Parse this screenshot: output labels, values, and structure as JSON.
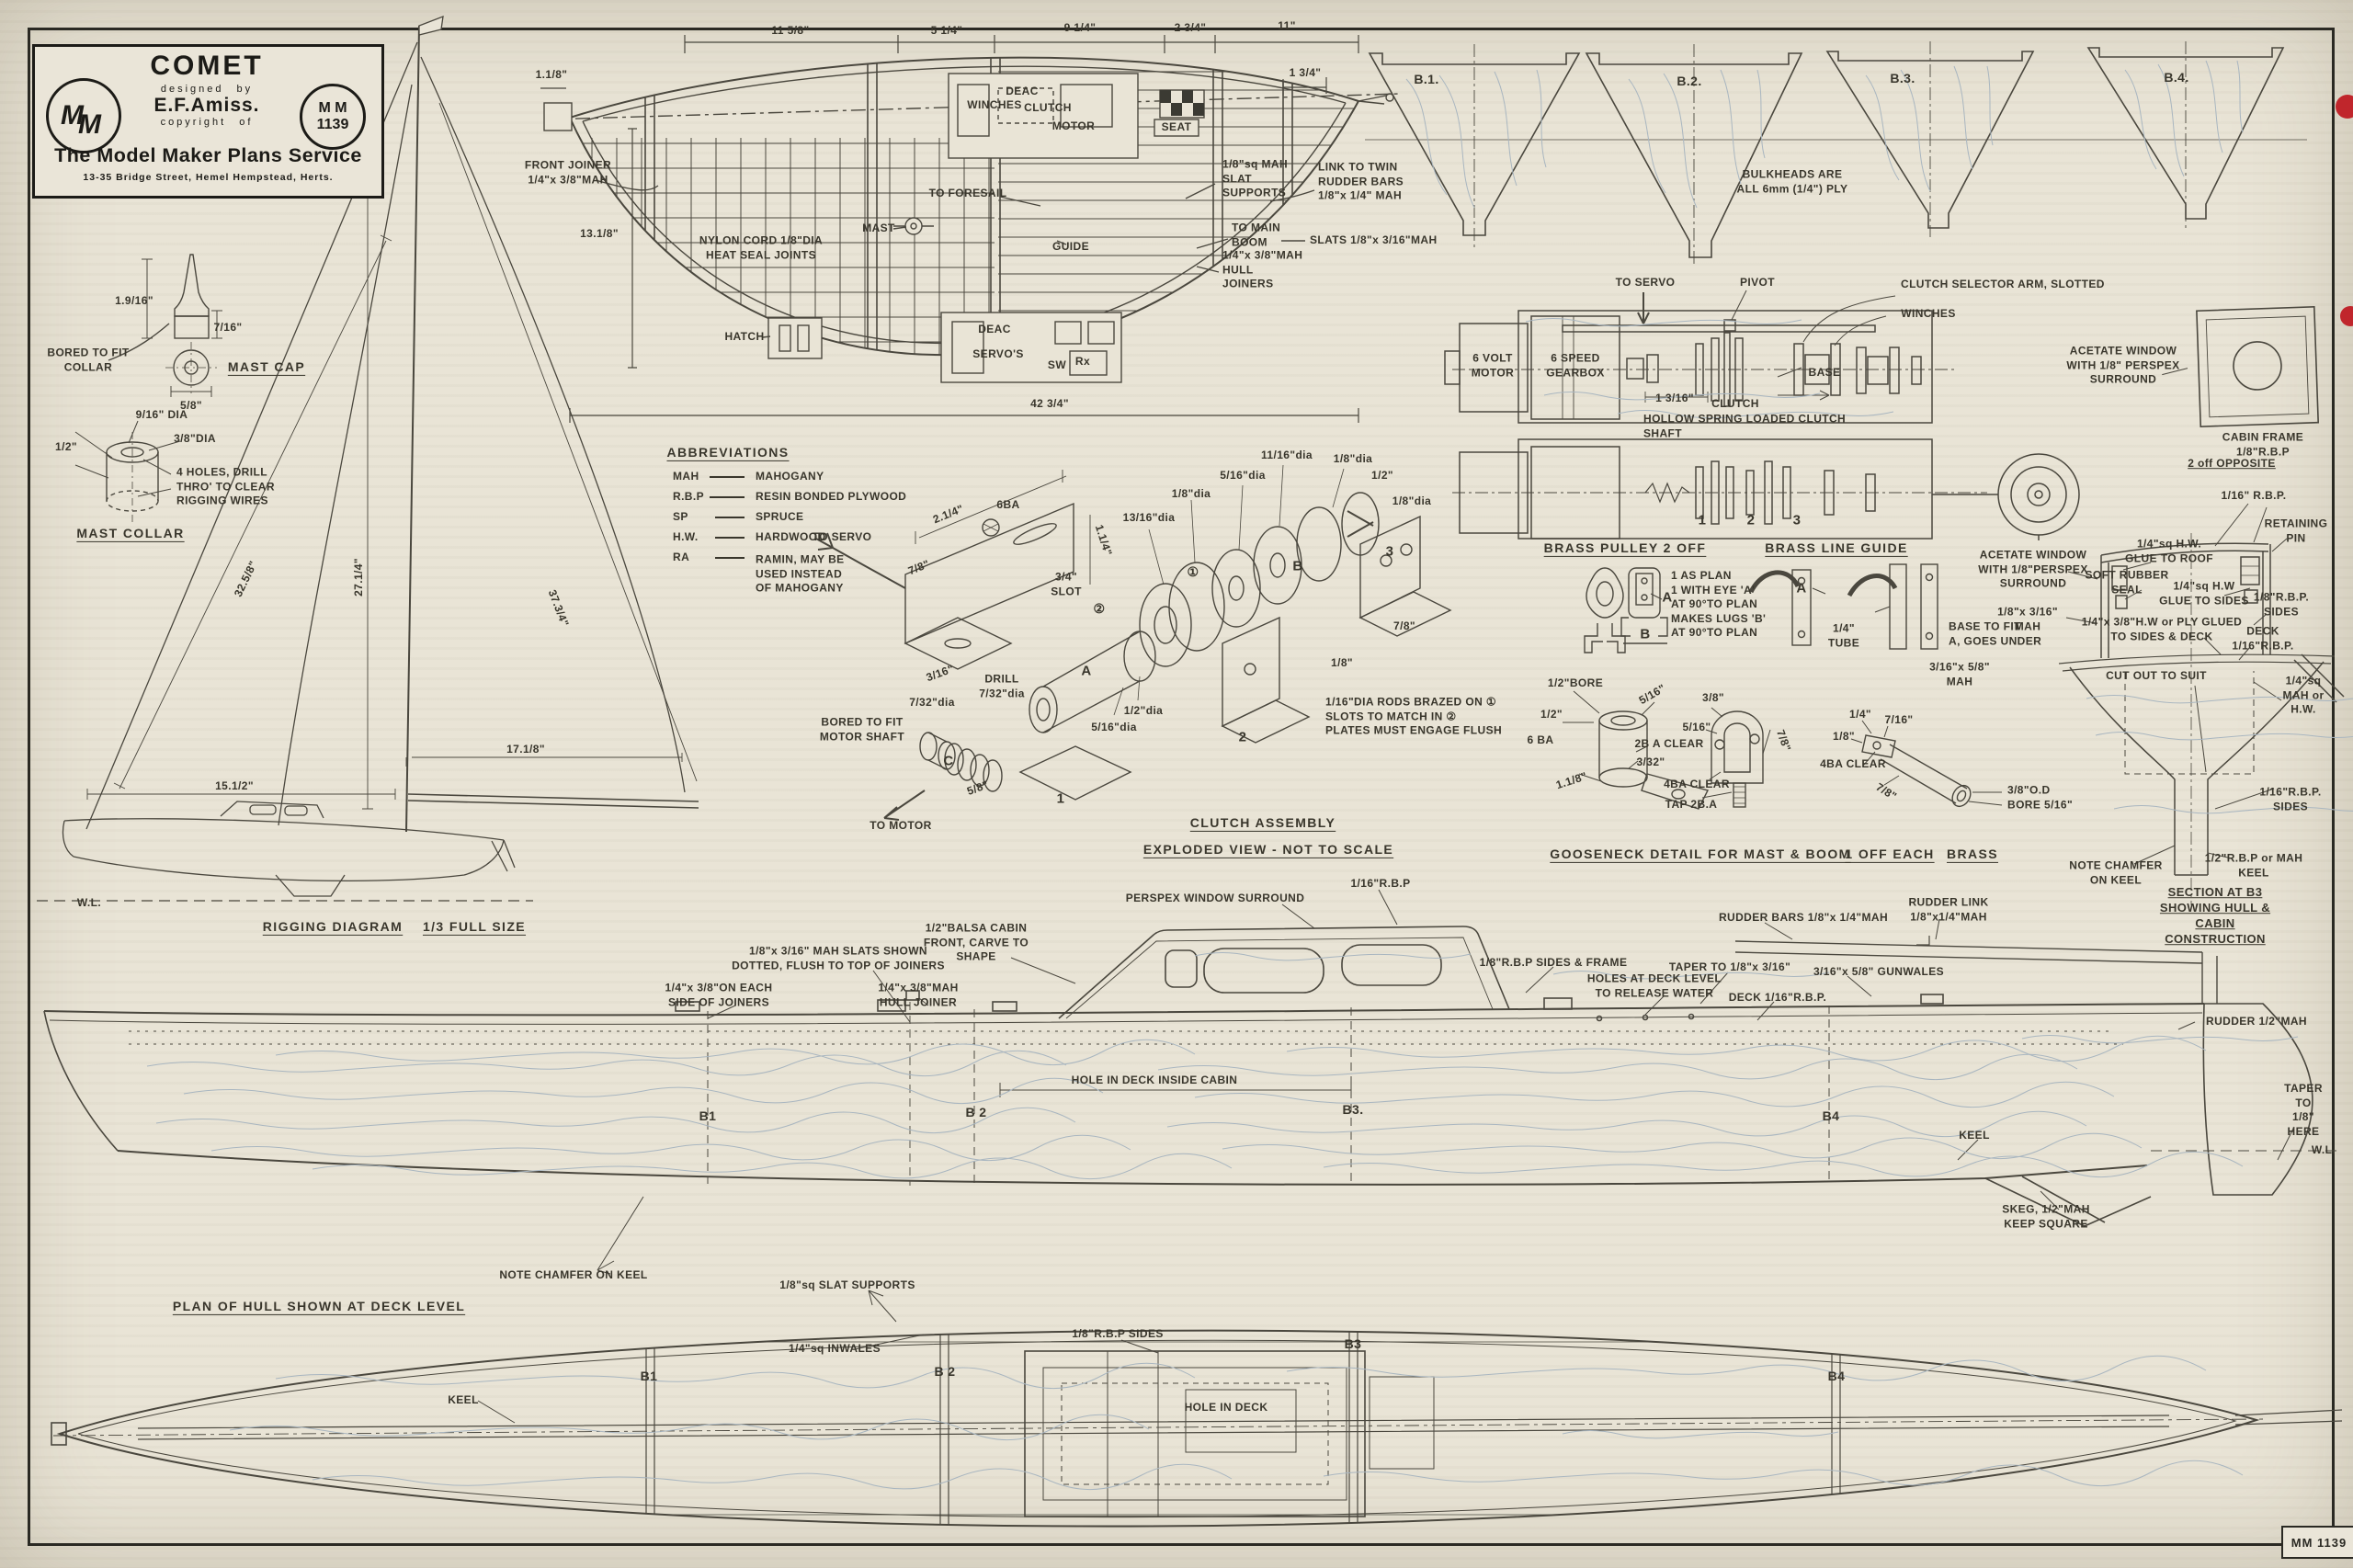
{
  "title": {
    "name": "COMET",
    "designed_by": "designed by",
    "designer": "E.F.Amiss.",
    "copyright_of": "copyright of",
    "logo_m1": "M",
    "logo_m2": "M",
    "plan_no_line1": "M M",
    "plan_no_line2": "1139",
    "service": "The Model Maker Plans Service",
    "address": "13-35 Bridge Street, Hemel Hempstead, Herts."
  },
  "deck": {
    "dim_11_58": "11 5/8\"",
    "dim_5_14": "5 1/4\"",
    "dim_9_14": "9 1/4\"",
    "dim_2_34": "2 3/4\"",
    "dim_11": "11\"",
    "dim_1_34": "1 3/4\"",
    "dim_1_18": "1.1/8\"",
    "dim_13_18": "13.1/8\"",
    "dim_overall": "42 3/4\"",
    "front_joiner": "FRONT JOINER\n1/4\"x 3/8\"MAH",
    "nylon": "NYLON CORD 1/8\"DIA\nHEAT SEAL JOINTS",
    "hatch": "HATCH",
    "mast": "MAST",
    "to_foresail": "TO FORESAIL",
    "guide": "GUIDE",
    "deac": "DEAC",
    "winches": "WINCHES",
    "clutch": "CLUTCH",
    "motor": "MOTOR",
    "seat": "SEAT",
    "deac2": "DEAC",
    "servos": "SERVO'S",
    "sw": "SW",
    "rx": "Rx",
    "slat_supports": "1/8\"sq MAH\nSLAT\nSUPPORTS",
    "link_rudder": "LINK TO TWIN\nRUDDER BARS\n1/8\"x 1/4\" MAH",
    "to_main_boom": "TO MAIN\nBOOM",
    "slats": "SLATS 1/8\"x 3/16\"MAH",
    "hull_joiners": "1/4\"x 3/8\"MAH\nHULL\nJOINERS"
  },
  "bulk": {
    "b1": "B.1.",
    "b2": "B.2.",
    "b3": "B.3.",
    "b4": "B.4.",
    "note": "BULKHEADS ARE\nALL 6mm (1/4\") PLY"
  },
  "mastcap": {
    "h": "1.9/16\"",
    "w": "7/16\"",
    "bored": "BORED TO FIT\nCOLLAR",
    "dia": "5/8\"",
    "title": "MAST CAP"
  },
  "collar": {
    "dia1": "9/16\" DIA",
    "dia2": "3/8\"DIA",
    "h": "1/2\"",
    "holes": "4 HOLES, DRILL\nTHRO' TO CLEAR\nRIGGING WIRES",
    "title": "MAST COLLAR"
  },
  "rig": {
    "forestay": "32.5/8\"",
    "luff": "27.1/4\"",
    "leech": "37.3/4\"",
    "boom": "17.1/8\"",
    "foot": "15.1/2\"",
    "wl": "W.L.",
    "title": "RIGGING DIAGRAM",
    "scale": "1/3 FULL SIZE"
  },
  "abbr": {
    "title": "ABBREVIATIONS",
    "r1a": "MAH",
    "r1b": "MAHOGANY",
    "r2a": "R.B.P",
    "r2b": "RESIN BONDED PLYWOOD",
    "r3a": "SP",
    "r3b": "SPRUCE",
    "r4a": "H.W.",
    "r4b": "HARDWOOD",
    "r5a": "RA",
    "r5b": "RAMIN, MAY BE\nUSED INSTEAD\nOF MAHOGANY"
  },
  "clutch": {
    "to_servo": "TO SERVO",
    "dim_2_14": "2.1/4\"",
    "dim_78_a": "7/8\"",
    "ba6": "6BA",
    "dim_1_14": "1.1/4\"",
    "slot": "3/4\"\nSLOT",
    "dim_3_16": "3/16\"",
    "drill": "DRILL\n7/32\"dia",
    "dim_7_32": "7/32\"dia",
    "bored": "BORED TO FIT\nMOTOR SHAFT",
    "to_motor": "TO MOTOR",
    "part_a": "A",
    "part_b": "B",
    "part_c": "C",
    "n1": "1",
    "n2": "2",
    "n3": "3",
    "c1": "①",
    "c2": "②",
    "dia_13_16": "13/16\"dia",
    "dia_18_a": "1/8\"dia",
    "dia_12": "1/2\"dia",
    "dia_5_16_a": "5/16\"dia",
    "dia_5_16_b": "5/16\"dia",
    "dia_11_16": "11/16\"dia",
    "dia_18_b": "1/8\"dia",
    "dim_12_b": "1/2\"",
    "dia_18_c": "1/8\"dia",
    "dim_78_b": "7/8\"",
    "dim_18_d": "1/8\"",
    "dim_58": "5/8\"",
    "note": "1/16\"DIA RODS BRAZED ON ①\nSLOTS TO MATCH IN ②\nPLATES MUST ENGAGE FLUSH",
    "title": "CLUTCH ASSEMBLY",
    "subtitle": "EXPLODED VIEW - NOT TO SCALE"
  },
  "motor": {
    "to_servo": "TO SERVO",
    "pivot": "PIVOT",
    "selector": "CLUTCH SELECTOR ARM, SLOTTED",
    "winches": "WINCHES",
    "motor": "6 VOLT\nMOTOR",
    "gearbox": "6 SPEED\nGEARBOX",
    "base": "BASE",
    "dim": "1 3/16\"",
    "clutch": "CLUTCH",
    "hollow": "HOLLOW SPRING LOADED CLUTCH\nSHAFT",
    "n1": "1",
    "n2": "2",
    "n3": "3"
  },
  "acetate": {
    "note": "ACETATE WINDOW\nWITH 1/8\" PERSPEX\nSURROUND",
    "cabin_frame": "CABIN FRAME 1/8\"R.B.P",
    "opposite": "2 off OPPOSITE"
  },
  "pulley": {
    "title": "BRASS PULLEY 2 OFF",
    "note": "1 AS PLAN\n1 WITH EYE 'A'\nAT 90°TO PLAN\nMAKES LUGS 'B'\nAT 90°TO PLAN",
    "a": "A",
    "b": "B"
  },
  "guide": {
    "title": "BRASS LINE GUIDE",
    "a": "A",
    "tube": "1/4\"\nTUBE",
    "base": "BASE TO FIT\nA, GOES UNDER"
  },
  "goose": {
    "bore": "1/2\"BORE",
    "dim_5_16_a": "5/16\"",
    "dim_12": "1/2\"",
    "ba6": "6 BA",
    "clear_2ba": "2B A CLEAR",
    "dim_3_32": "3/32\"",
    "dim_1_18": "1.1/8\"",
    "dim_38": "3/8\"",
    "dim_5_16_b": "5/16\"",
    "dim_78_a": "7/8\"",
    "clear_4ba_a": "4BA CLEAR",
    "tap": "TAP 2B.A",
    "dim_14": "1/4\"",
    "dim_7_16": "7/16\"",
    "dim_18": "1/8\"",
    "clear_4ba_b": "4BA CLEAR",
    "dim_78_b": "7/8\"",
    "od": "3/8\"O.D\nBORE 5/16\"",
    "mah": "3/16\"x 5/8\"\nMAH",
    "title": "GOOSENECK DETAIL FOR MAST & BOOM",
    "off": "1 OFF EACH",
    "brass": "BRASS"
  },
  "sect": {
    "rbp_1_16": "1/16\" R.B.P.",
    "retaining": "RETAINING PIN",
    "glue_roof": "1/4\"sq H.W.\nGLUE TO ROOF",
    "seal": "SOFT RUBBER\nSEAL",
    "acetate": "ACETATE WINDOW\nWITH 1/8\"PERSPEX\nSURROUND",
    "mah_18": "1/8\"x 3/16\"\nMAH",
    "glue_sides": "1/4\"sq H.W\nGLUE TO SIDES",
    "rbp_sides": "1/8\"R.B.P.\nSIDES",
    "hw_ply": "1/4\"x 3/8\"H.W or PLY GLUED\nTO SIDES & DECK",
    "deck": "DECK\n1/16\"R.B.P.",
    "cut_out": "CUT OUT TO SUIT",
    "mah_sq": "1/4\"sq\nMAH or H.W.",
    "sides_1_16": "1/16\"R.B.P.\nSIDES",
    "keel": "1/2\"R.B.P or MAH KEEL",
    "chamfer": "NOTE CHAMFER\nON KEEL",
    "title": "SECTION AT B3 SHOWING HULL &\nCABIN CONSTRUCTION"
  },
  "hull": {
    "perspex": "PERSPEX WINDOW SURROUND",
    "rbp_1_16": "1/16\"R.B.P",
    "balsa": "1/2\"BALSA CABIN\nFRONT, CARVE TO\nSHAPE",
    "slats_dotted": "1/8\"x 3/16\" MAH SLATS SHOWN\nDOTTED, FLUSH TO TOP OF JOINERS",
    "side_joiners": "1/4\"x 3/8\"ON EACH\nSIDE OF JOINERS",
    "hull_joiner": "1/4\"x 3/8\"MAH\nHULL JOINER",
    "rbp_frame": "1/8\"R.B.P SIDES & FRAME",
    "rudder_bars": "RUDDER BARS 1/8\"x 1/4\"MAH",
    "rudder_link": "RUDDER LINK\n1/8\"x1/4\"MAH",
    "taper": "TAPER TO 1/8\"x 3/16\"",
    "gunwales": "3/16\"x 5/8\" GUNWALES",
    "holes": "HOLES AT DECK LEVEL\nTO RELEASE WATER",
    "deck": "DECK 1/16\"R.B.P.",
    "hole_dim": "HOLE IN DECK INSIDE CABIN",
    "rudder": "RUDDER 1/2\"MAH",
    "taper_here": "TAPER TO\n1/8\"\nHERE",
    "wl": "W.L.",
    "keel": "KEEL",
    "skeg": "SKEG, 1/2\"MAH\nKEEP SQUARE",
    "chamfer": "NOTE CHAMFER ON KEEL",
    "b1": "B1",
    "b2": "B 2",
    "b3": "B3.",
    "b4": "B4"
  },
  "plan": {
    "title": "PLAN OF HULL SHOWN AT DECK LEVEL",
    "slat_supports": "1/8\"sq SLAT SUPPORTS",
    "inwales": "1/4\"sq INWALES",
    "rbp_sides": "1/8\"R.B.P SIDES",
    "hole": "HOLE IN DECK",
    "keel": "KEEL",
    "b1": "B1",
    "b2": "B 2",
    "b3": "B3",
    "b4": "B4"
  },
  "footer": {
    "plan_no": "MM 1139"
  },
  "colors": {
    "paper": "#e9e4d6",
    "ink": "#4a473e",
    "grain": "#a9b6c0",
    "red": "#c0262c"
  }
}
